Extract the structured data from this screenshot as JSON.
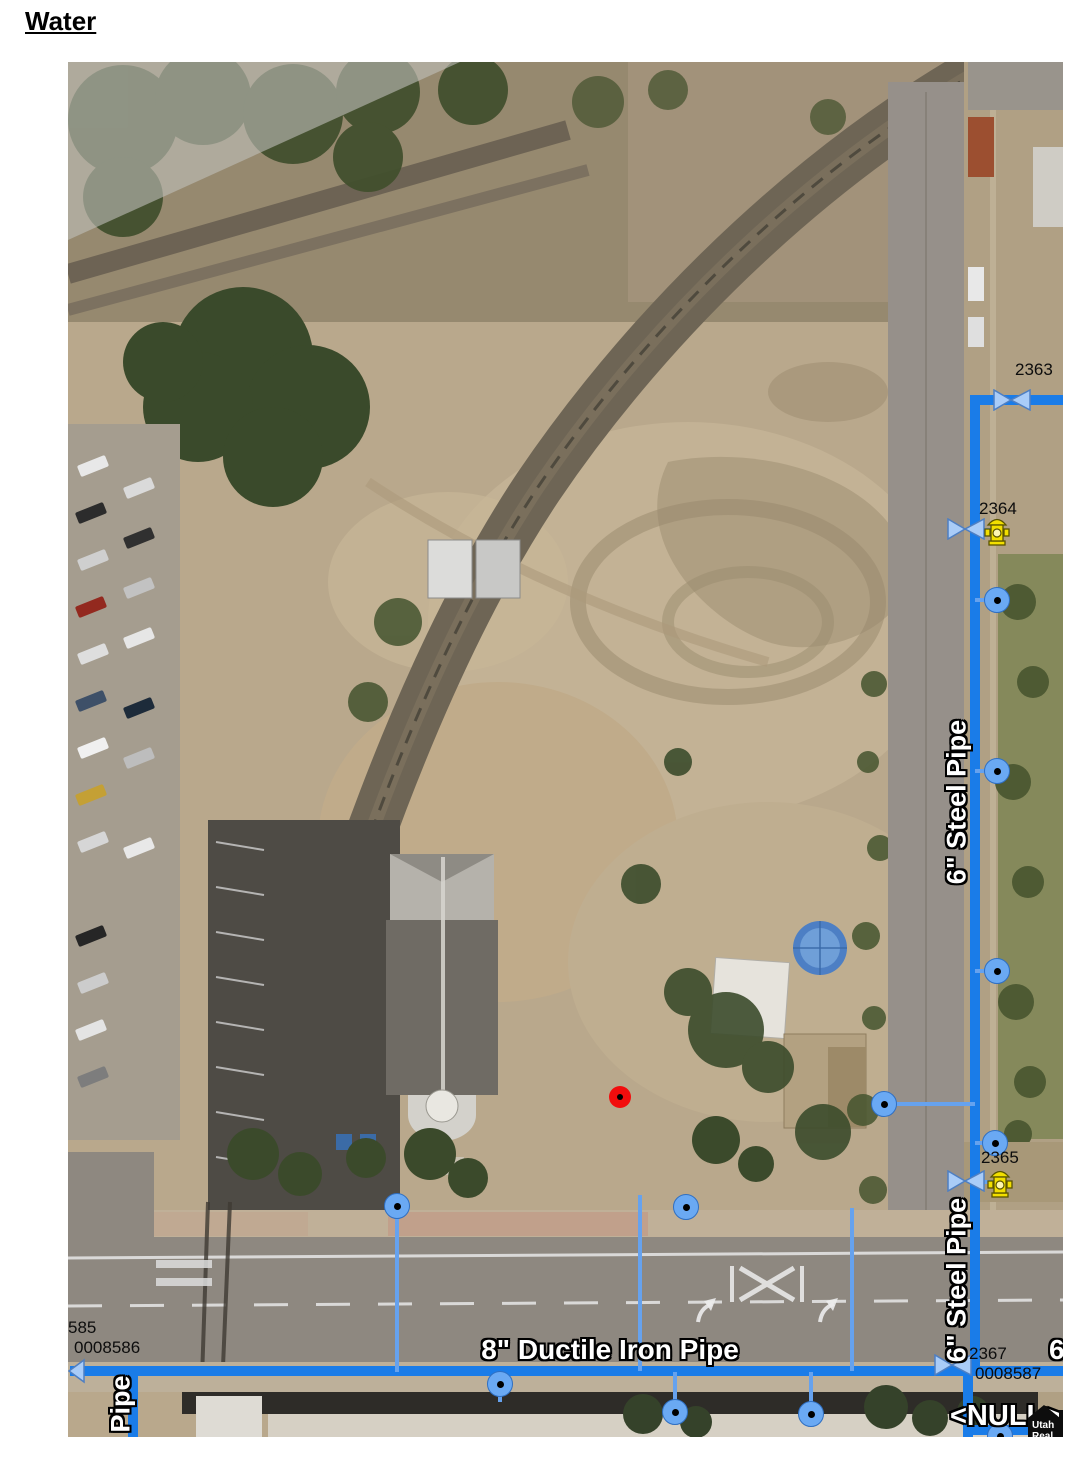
{
  "page": {
    "title": "Water"
  },
  "map": {
    "feature_labels": {
      "valve_2363": "2363",
      "hydrant_2364": "2364",
      "hydrant_2365": "2365",
      "valve_2367": "2367",
      "lateral_585": "585",
      "lateral_0008586": "0008586",
      "lateral_0008587": "0008587",
      "main_8in": "8\" Ductile Iron Pipe",
      "main_6in_upper": "6\" Steel Pipe",
      "main_6in_lower": "6\" Steel Pipe",
      "main_partial_left": "Pipe",
      "main_partial_right": "6\"",
      "null_value": "<NULL>"
    },
    "watermark": {
      "line1": "Utah",
      "line2": "Real"
    },
    "colors": {
      "pipe_main": "#1a7ce8",
      "pipe_service": "#66a2ee",
      "node": "#6aa9f3",
      "valve": "#a9ccf8",
      "hydrant": "#f2df00",
      "selection_marker": "#f20d0d"
    }
  }
}
